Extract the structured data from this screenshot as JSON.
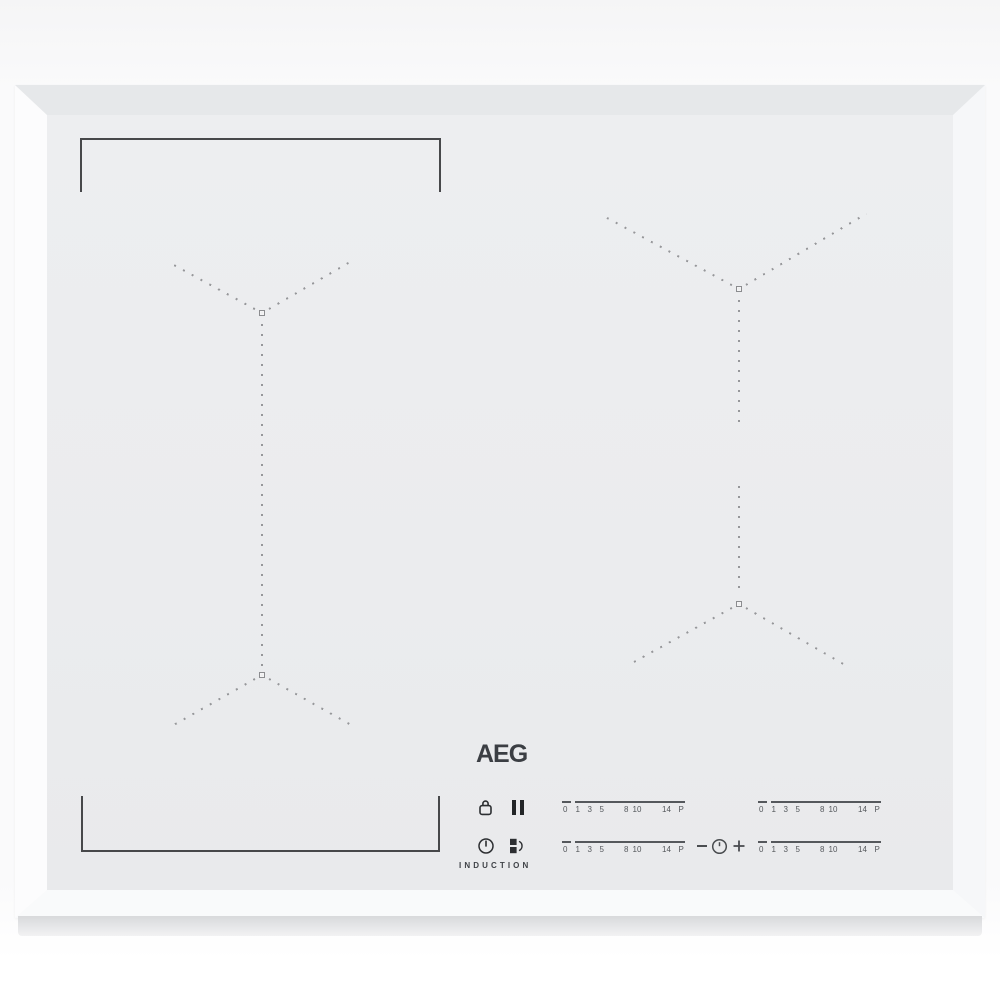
{
  "product": {
    "brand_logo": "AEG",
    "type_label": "INDUCTION"
  },
  "control_panel": {
    "icons": {
      "lock": "lock-icon",
      "pause": "pause-icon",
      "power": "power-icon",
      "bridge": "bridge-icon",
      "timer_clock": "timer-clock-icon"
    },
    "timer": {
      "minus": "−",
      "plus": "+"
    },
    "slider_scale": [
      "0",
      "1",
      "3",
      "5",
      "8",
      "10",
      "14",
      "P"
    ]
  },
  "colors": {
    "glass_surface": "#ebecee",
    "bevel_frame": "#f9fafb",
    "marker_dots": "#96979a",
    "bracket_line": "#47484a",
    "icon_dark": "#2c2e31",
    "scale_text": "#55585c"
  }
}
